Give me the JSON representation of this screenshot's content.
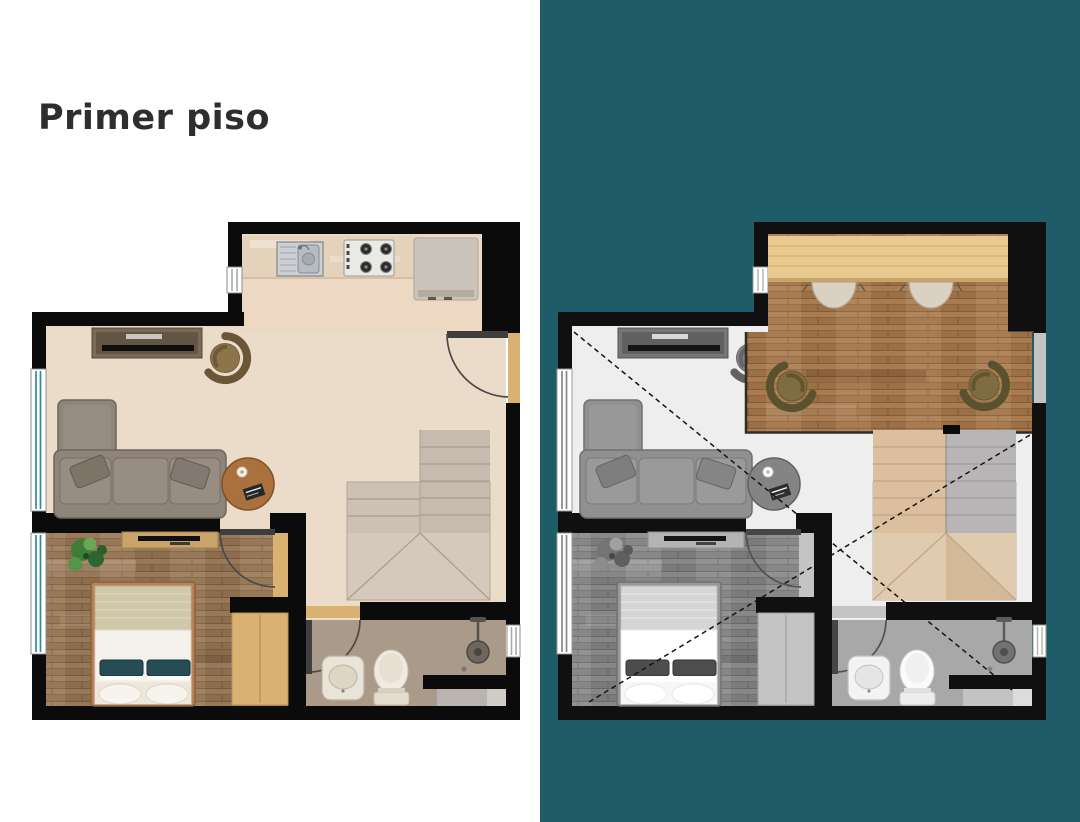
{
  "panels": {
    "first_floor": {
      "title": "Primer piso"
    },
    "second_floor": {
      "title": "Segundo piso"
    }
  },
  "colors": {
    "teal_panel": "#1e5c68",
    "title_dark": "#2e2e2e",
    "title_light": "#ffffff",
    "wall": "#0b0b0b",
    "floor_main": "#eadcc8",
    "floor_kitchen": "#ecd8c3",
    "floor_bedroom": "#977858",
    "floor_bath": "#a99a8a",
    "stairs_beige": "#c6bbae",
    "stairs_winder": "#d4c9bb",
    "stairs_highlight": "#dcbf9f",
    "stairs_gray": "#b8b5b6",
    "sofa_gray": "#8e847a",
    "table_wood": "#aa713e",
    "closet_wood": "#d9b271",
    "bed_linen": "#f4f1ea",
    "pillow_teal": "#264d53",
    "study_floor": "#a87b50",
    "desk_wood": "#e8ca90",
    "chair_cream": "#dbd1c2",
    "chair_olive": "#7e6c42",
    "window_teal": "#2f8c9b"
  }
}
